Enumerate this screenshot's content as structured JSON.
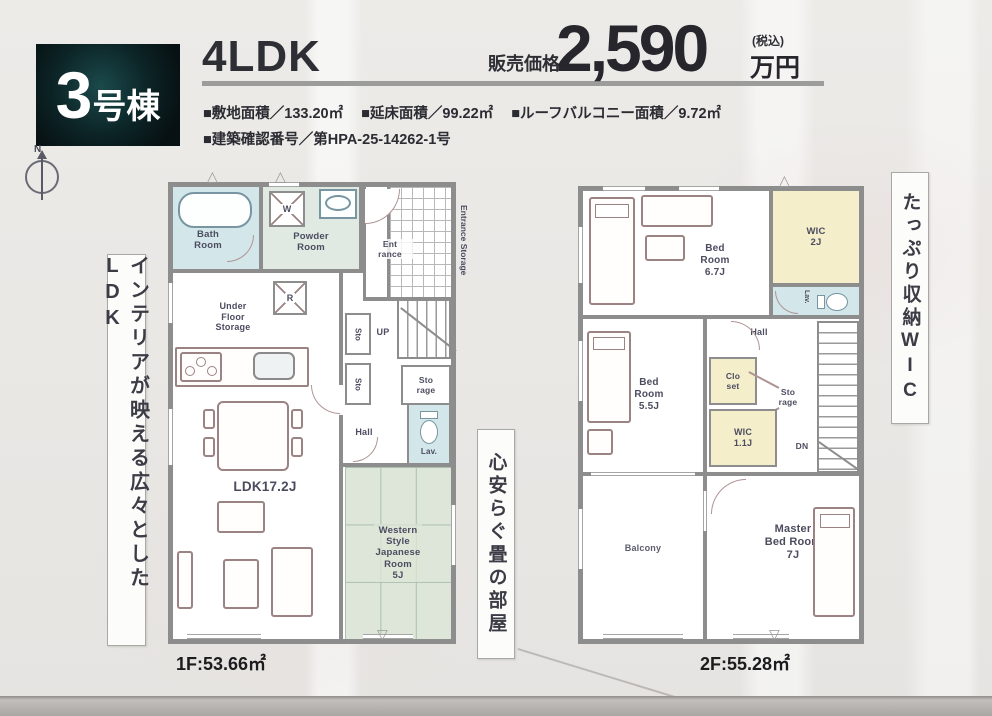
{
  "header": {
    "building_number": "3",
    "building_suffix": "号棟",
    "plan_type": "4LDK",
    "price_label": "販売価格",
    "price_value": "2,590",
    "price_tax": "(税込)",
    "price_unit": "万円",
    "spec_site_area": "■敷地面積／133.20㎡",
    "spec_floor_area": "■延床面積／99.22㎡",
    "spec_roof_balcony": "■ルーフバルコニー面積／9.72㎡",
    "spec_confirmation": "■建築確認番号／第HPA-25-14262-1号"
  },
  "compass": {
    "north_label": "N"
  },
  "captions": {
    "left": "インテリアが映える広々としたLDK",
    "tatami": "心安らぐ畳の部屋",
    "wic": "たっぷり収納WIC"
  },
  "floor1": {
    "area_label": "1F:53.66㎡",
    "rooms": {
      "bath": "Bath\nRoom",
      "powder": "Powder\nRoom",
      "washer": "W",
      "fridge": "R",
      "entrance": "Ent\nrance",
      "entrance_storage": "Entrance Storage",
      "under_floor_storage": "Under\nFloor\nStorage",
      "sto_a": "Sto",
      "sto_b": "Sto",
      "up": "UP",
      "storage": "Sto\nrage",
      "hall": "Hall",
      "lav": "Lav.",
      "ldk": "LDK17.2J",
      "japanese_room": "Western\nStyle\nJapanese\nRoom\n5J"
    }
  },
  "floor2": {
    "area_label": "2F:55.28㎡",
    "rooms": {
      "bedroom1": "Bed\nRoom\n6.7J",
      "wic_2j": "WIC\n2J",
      "lav": "Lav.",
      "hall": "Hall",
      "bedroom2": "Bed\nRoom\n5.5J",
      "closet": "Clo\nset",
      "storage": "Sto\nrage",
      "wic_11j": "WIC\n1.1J",
      "dn": "DN",
      "balcony": "Balcony",
      "master": "Master\nBed Room\n7J"
    }
  },
  "colors": {
    "accent_dark_teal": "#0c2426",
    "wall_gray": "#8d8d8d",
    "water_blue": "#d3e7ea",
    "powder_green": "#e0e9e2",
    "tatami_green": "#dde6d8",
    "wic_yellow": "#f4eecb"
  }
}
